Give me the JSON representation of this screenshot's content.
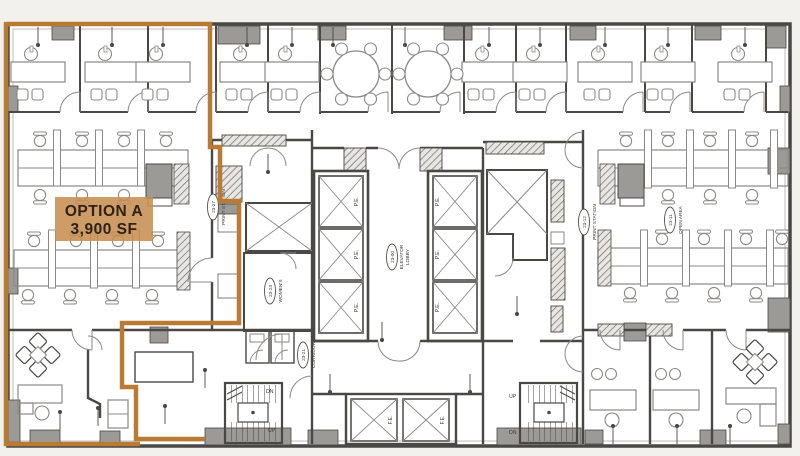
{
  "option": {
    "title": "OPTION A",
    "area": "3,900 SF"
  },
  "rooms": {
    "print_left": {
      "id": "23-27",
      "name": "PRINT STATION"
    },
    "womens": {
      "id": "23-24",
      "name": "WOMEN'S"
    },
    "lobby": {
      "id": "23-00",
      "name": "ELEVATOR",
      "name2": "LOBBY"
    },
    "corridor": {
      "id": "23-21",
      "name": "CORRIDOR"
    },
    "print_right": {
      "id": "23-12",
      "name": "PRINT STATION"
    },
    "open_area": {
      "id": "23-11",
      "name": "OPEN AREA"
    }
  },
  "labels": {
    "pe": "P.E.",
    "fe": "F.E.",
    "dn": "DN",
    "up": "UP"
  },
  "colors": {
    "highlight_outline": "#b97a33",
    "option_label_bg": "#c68e52",
    "option_label_text": "#2e2115",
    "wall": "#4a4845",
    "column_fill": "#9c9a96",
    "furniture_line": "#8b8987",
    "background": "#f3f1ee",
    "floor": "#ffffff"
  }
}
